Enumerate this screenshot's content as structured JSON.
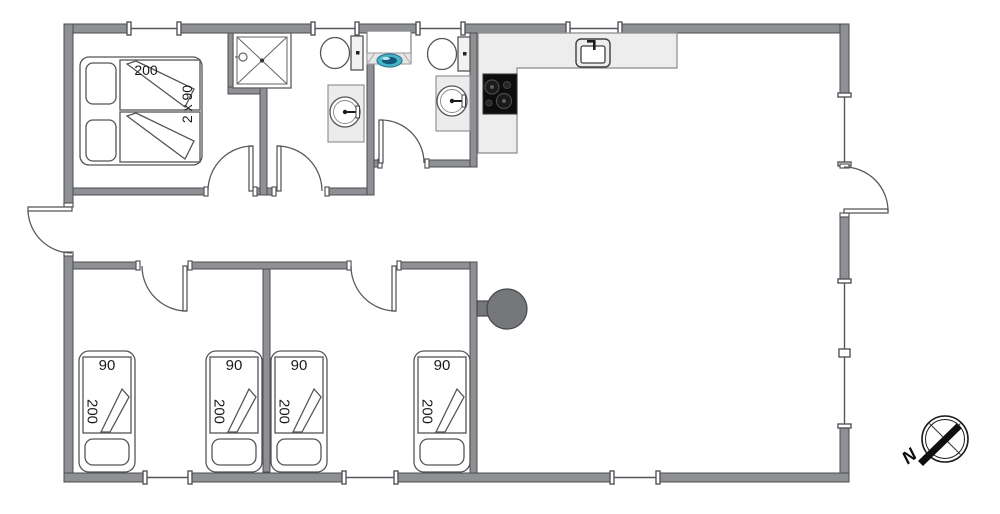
{
  "labels": {
    "double_bed_length": "200",
    "double_bed_width": "2 x 90",
    "single_beds": [
      {
        "width": "90",
        "length": "200"
      },
      {
        "width": "90",
        "length": "200"
      },
      {
        "width": "90",
        "length": "200"
      },
      {
        "width": "90",
        "length": "200"
      }
    ],
    "compass_north": "N"
  },
  "icons": [
    "shower-cabin",
    "toilet",
    "washbasin",
    "washing-machine",
    "kitchen-sink",
    "cooktop",
    "wood-stove",
    "door",
    "window",
    "compass-rose"
  ],
  "colors": {
    "wall_fill": "#8e9093",
    "wall_outline": "#4c4d50",
    "counter_fill": "#ededee",
    "cooktop_fill": "#0d0d0d",
    "stove_fill": "#76777a",
    "washer_door": "#49b4c6",
    "line": "#555555"
  }
}
